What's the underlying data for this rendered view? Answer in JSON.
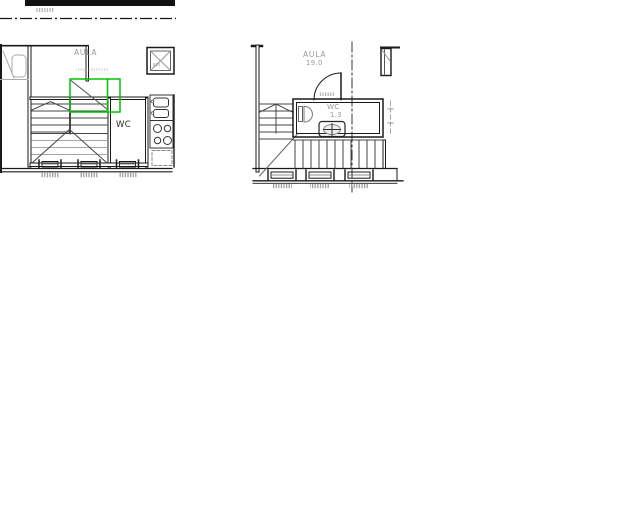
{
  "drawing": {
    "type": "architectural-floor-plan",
    "left_plan": {
      "room_label": "AULA",
      "wc_label": "WC"
    },
    "right_plan": {
      "room_label": "AULA",
      "room_area": "19.0",
      "wc_label": "WC",
      "wc_area": "1.3"
    }
  },
  "colors": {
    "background": "#ffffff",
    "line": "#1a1a1a",
    "secondary_line": "#555555",
    "gray_annotation": "#9a9a9a",
    "highlight_green": "#00c300"
  }
}
